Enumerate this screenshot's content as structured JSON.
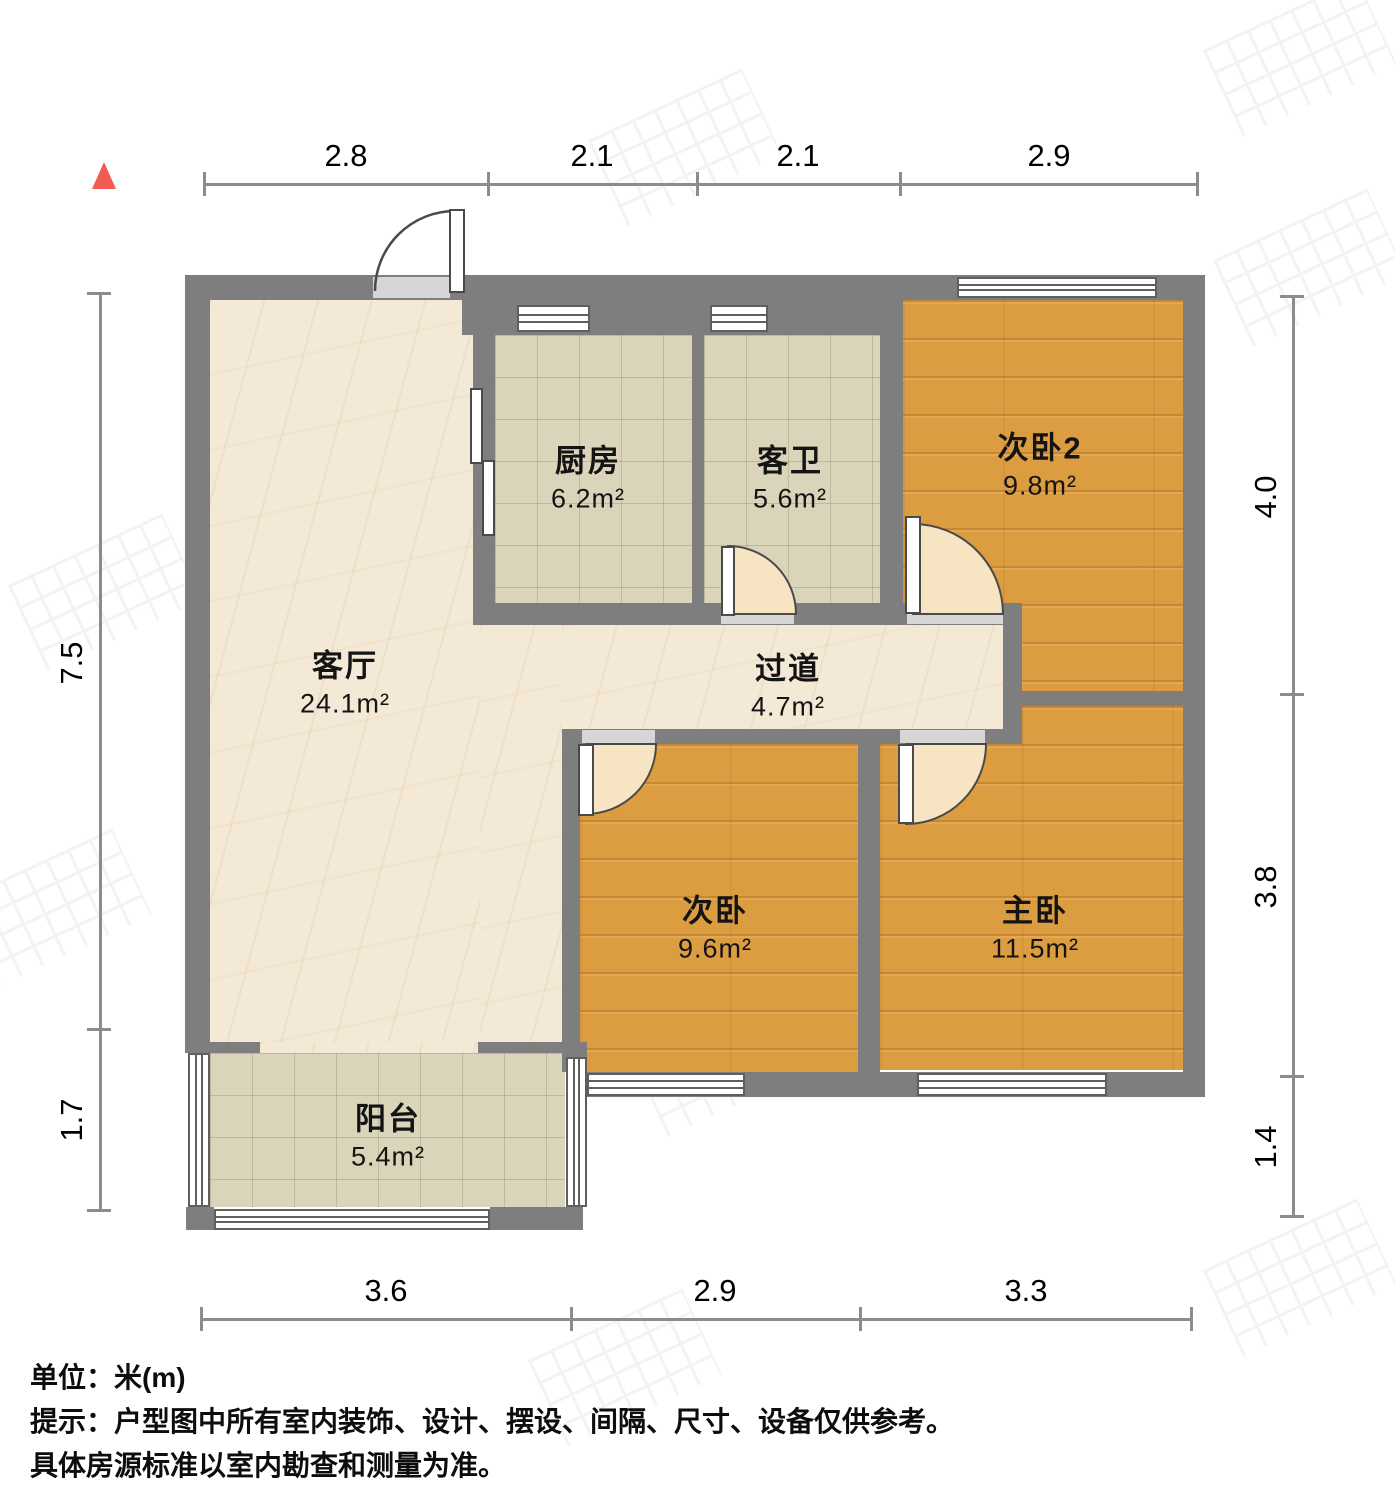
{
  "meta": {
    "unit_label": "单位：米(m)",
    "tip_line1": "提示：户型图中所有室内装饰、设计、摆设、间隔、尺寸、设备仅供参考。",
    "tip_line2": "具体房源标准以室内勘查和测量为准。"
  },
  "rooms": {
    "living": {
      "name": "客厅",
      "area": "24.1m²"
    },
    "kitchen": {
      "name": "厨房",
      "area": "6.2m²"
    },
    "bath": {
      "name": "客卫",
      "area": "5.6m²"
    },
    "bedroom2": {
      "name": "次卧2",
      "area": "9.8m²"
    },
    "hall": {
      "name": "过道",
      "area": "4.7m²"
    },
    "bedroom": {
      "name": "次卧",
      "area": "9.6m²"
    },
    "master": {
      "name": "主卧",
      "area": "11.5m²"
    },
    "balcony": {
      "name": "阳台",
      "area": "5.4m²"
    }
  },
  "dims": {
    "top": [
      "2.8",
      "2.1",
      "2.1",
      "2.9"
    ],
    "left": [
      "7.5",
      "1.7"
    ],
    "right": [
      "4.0",
      "3.8",
      "1.4"
    ],
    "bottom": [
      "3.6",
      "2.9",
      "3.3"
    ]
  },
  "colors": {
    "wall": "#7e7e7e",
    "wood_floor": "#dc9c40",
    "tile_floor": "#d9d4ba",
    "marble_floor": "#f3e9d6",
    "north_marker": "#f25a52"
  }
}
